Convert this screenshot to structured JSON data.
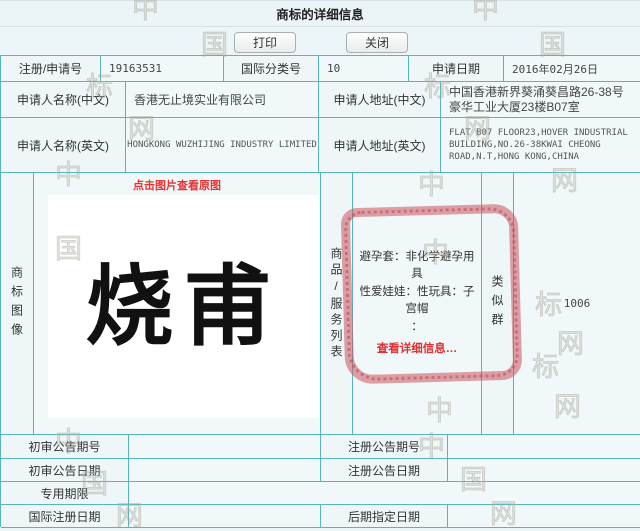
{
  "header": {
    "title": "商标的详细信息",
    "print_label": "打印",
    "close_label": "关闭"
  },
  "fields": {
    "reg_no": {
      "label": "注册/申请号",
      "value": "19163531"
    },
    "intl_class": {
      "label": "国际分类号",
      "value": "10"
    },
    "app_date": {
      "label": "申请日期",
      "value": "2016年02月26日"
    },
    "applicant_cn": {
      "label": "申请人名称(中文)",
      "value": "香港无止境实业有限公司"
    },
    "addr_cn": {
      "label": "申请人地址(中文)",
      "value": "中国香港新界葵涌葵昌路26-38号豪华工业大厦23楼B07室"
    },
    "applicant_en": {
      "label": "申请人名称(英文)",
      "value": "HONGKONG WUZHIJING INDUSTRY LIMITED"
    },
    "addr_en": {
      "label": "申请人地址(英文)",
      "value": "FLAT B07 FLOOR23,HOVER INDUSTRIAL BUILDING,NO.26-38KWAI CHEONG ROAD,N.T,HONG KONG,CHINA"
    }
  },
  "trademark": {
    "image_col_label": "商标图像",
    "view_original_link": "点击图片查看原图",
    "image_text": "烧甫",
    "goods_col_label": "商品/服务列表",
    "goods_line1": "避孕套：非化学避孕用具",
    "goods_line2": "性爱娃娃：性玩具：子宫帽",
    "goods_line3": "：",
    "detail_link": "查看详细信息…",
    "similar_group_label": "类似群",
    "similar_group_value": "1006"
  },
  "bottom": {
    "first_trial_no": {
      "label": "初审公告期号",
      "value": ""
    },
    "reg_announce_no": {
      "label": "注册公告期号",
      "value": ""
    },
    "first_trial_date": {
      "label": "初审公告日期",
      "value": ""
    },
    "reg_announce_date": {
      "label": "注册公告日期",
      "value": ""
    },
    "exclusive_period": {
      "label": "专用期限",
      "value": ""
    },
    "intl_reg_date": {
      "label": "国际注册日期",
      "value": ""
    },
    "later_designation_date": {
      "label": "后期指定日期",
      "value": ""
    }
  },
  "colors": {
    "border_teal": "#57b6b8",
    "link_red": "#e53333",
    "annotation_red": "#c9545e",
    "page_bg": "#ecf5f7"
  },
  "watermark": {
    "glyphs": [
      {
        "c": "中",
        "x": 132,
        "y": -4
      },
      {
        "c": "中",
        "x": 472,
        "y": -4
      },
      {
        "c": "国",
        "x": 201,
        "y": 32
      },
      {
        "c": "国",
        "x": 539,
        "y": 32
      },
      {
        "c": "标",
        "x": 86,
        "y": 74
      },
      {
        "c": "标",
        "x": 424,
        "y": 74
      },
      {
        "c": "网",
        "x": 128,
        "y": 116
      },
      {
        "c": "网",
        "x": 464,
        "y": 116
      },
      {
        "c": "中",
        "x": 55,
        "y": 162
      },
      {
        "c": "中",
        "x": 418,
        "y": 172
      },
      {
        "c": "网",
        "x": 551,
        "y": 168
      },
      {
        "c": "国",
        "x": 55,
        "y": 236
      },
      {
        "c": "中",
        "x": 422,
        "y": 240
      },
      {
        "c": "标",
        "x": 535,
        "y": 292
      },
      {
        "c": "网",
        "x": 557,
        "y": 331
      },
      {
        "c": "标",
        "x": 532,
        "y": 354
      },
      {
        "c": "网",
        "x": 554,
        "y": 394
      },
      {
        "c": "中",
        "x": 426,
        "y": 398
      },
      {
        "c": "中",
        "x": 55,
        "y": 429
      },
      {
        "c": "中",
        "x": 418,
        "y": 434
      },
      {
        "c": "国",
        "x": 81,
        "y": 471
      },
      {
        "c": "国",
        "x": 460,
        "y": 467
      },
      {
        "c": "网",
        "x": 116,
        "y": 503
      },
      {
        "c": "网",
        "x": 490,
        "y": 501
      }
    ]
  }
}
